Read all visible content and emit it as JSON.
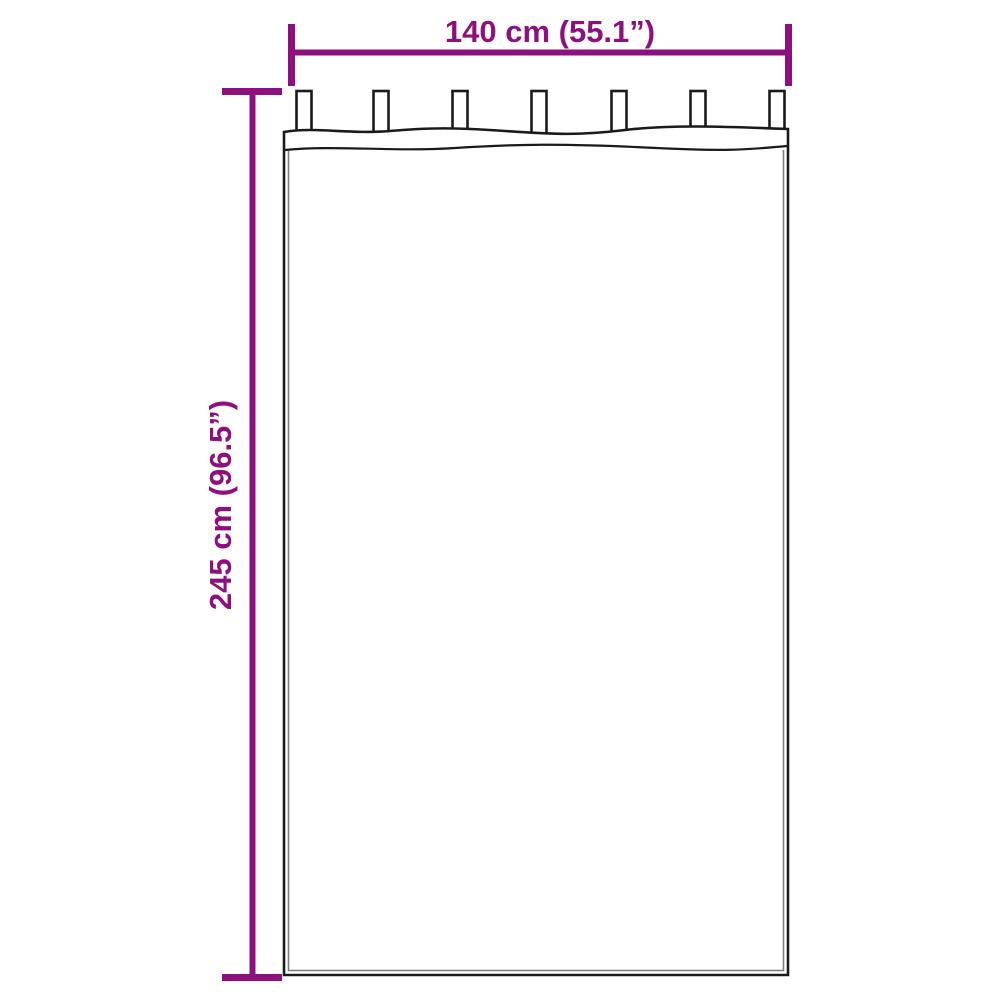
{
  "diagram": {
    "type": "product-dimension-diagram",
    "subject": "curtain-with-tab-tops",
    "width_label": "140 cm (55.1”)",
    "height_label": "245 cm (96.5”)",
    "tab_count": 7,
    "colors": {
      "accent": "#8D107E",
      "outline": "#1A1A1A",
      "inner_line": "#7C7C7C",
      "background": "#FFFFFF"
    }
  }
}
